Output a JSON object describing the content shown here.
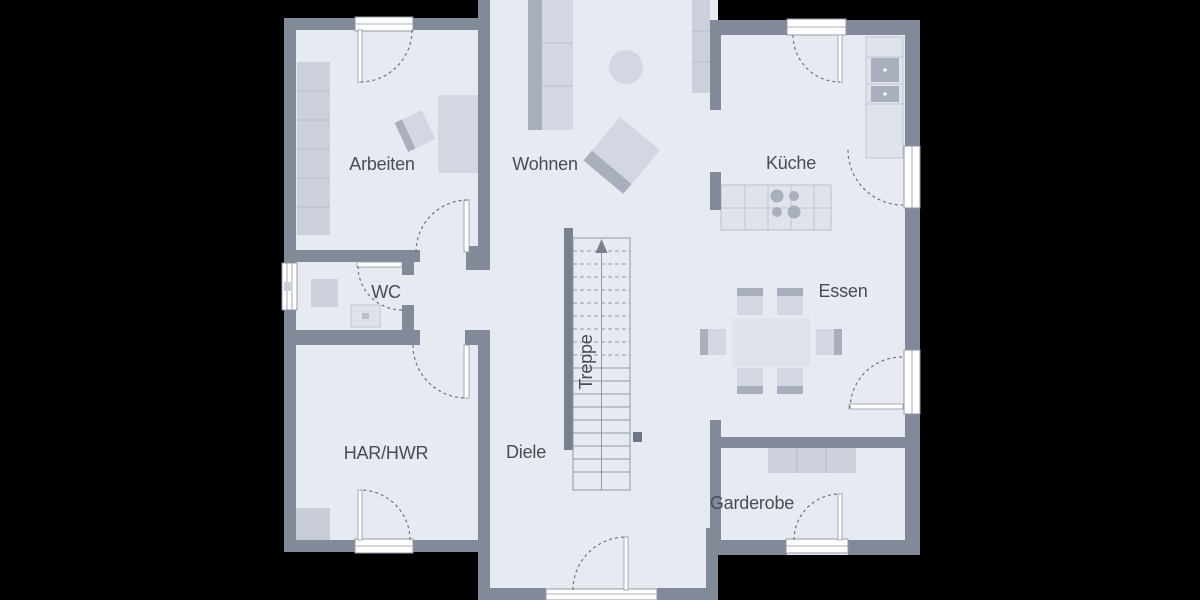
{
  "plan_type": "floor-plan",
  "rooms": {
    "arbeiten": {
      "label": "Arbeiten"
    },
    "wohnen": {
      "label": "Wohnen"
    },
    "kueche": {
      "label": "Küche"
    },
    "wc": {
      "label": "WC"
    },
    "essen": {
      "label": "Essen"
    },
    "har_hwr": {
      "label": "HAR/HWR"
    },
    "diele": {
      "label": "Diele"
    },
    "treppe": {
      "label": "Treppe"
    },
    "garderobe": {
      "label": "Garderobe"
    }
  },
  "icons": {
    "stairs_direction": "up-arrow",
    "door_swing": "quarter-circle-dashed",
    "window": "double-line-frame"
  },
  "colors": {
    "background": "#000000",
    "wall": "#828a99",
    "wall_dark": "#79818f",
    "floor": "#e8eaf1",
    "furn_light": "#d3d7e1",
    "furn_mid": "#cbd0db",
    "furn_dark": "#a9afbc",
    "counter": "#e0e3ea",
    "line": "#b7bdc9",
    "outline": "#9098a8",
    "arc": "#6f7585",
    "label": "#474c59",
    "pillar": "#6f7689",
    "white": "#ffffff"
  }
}
